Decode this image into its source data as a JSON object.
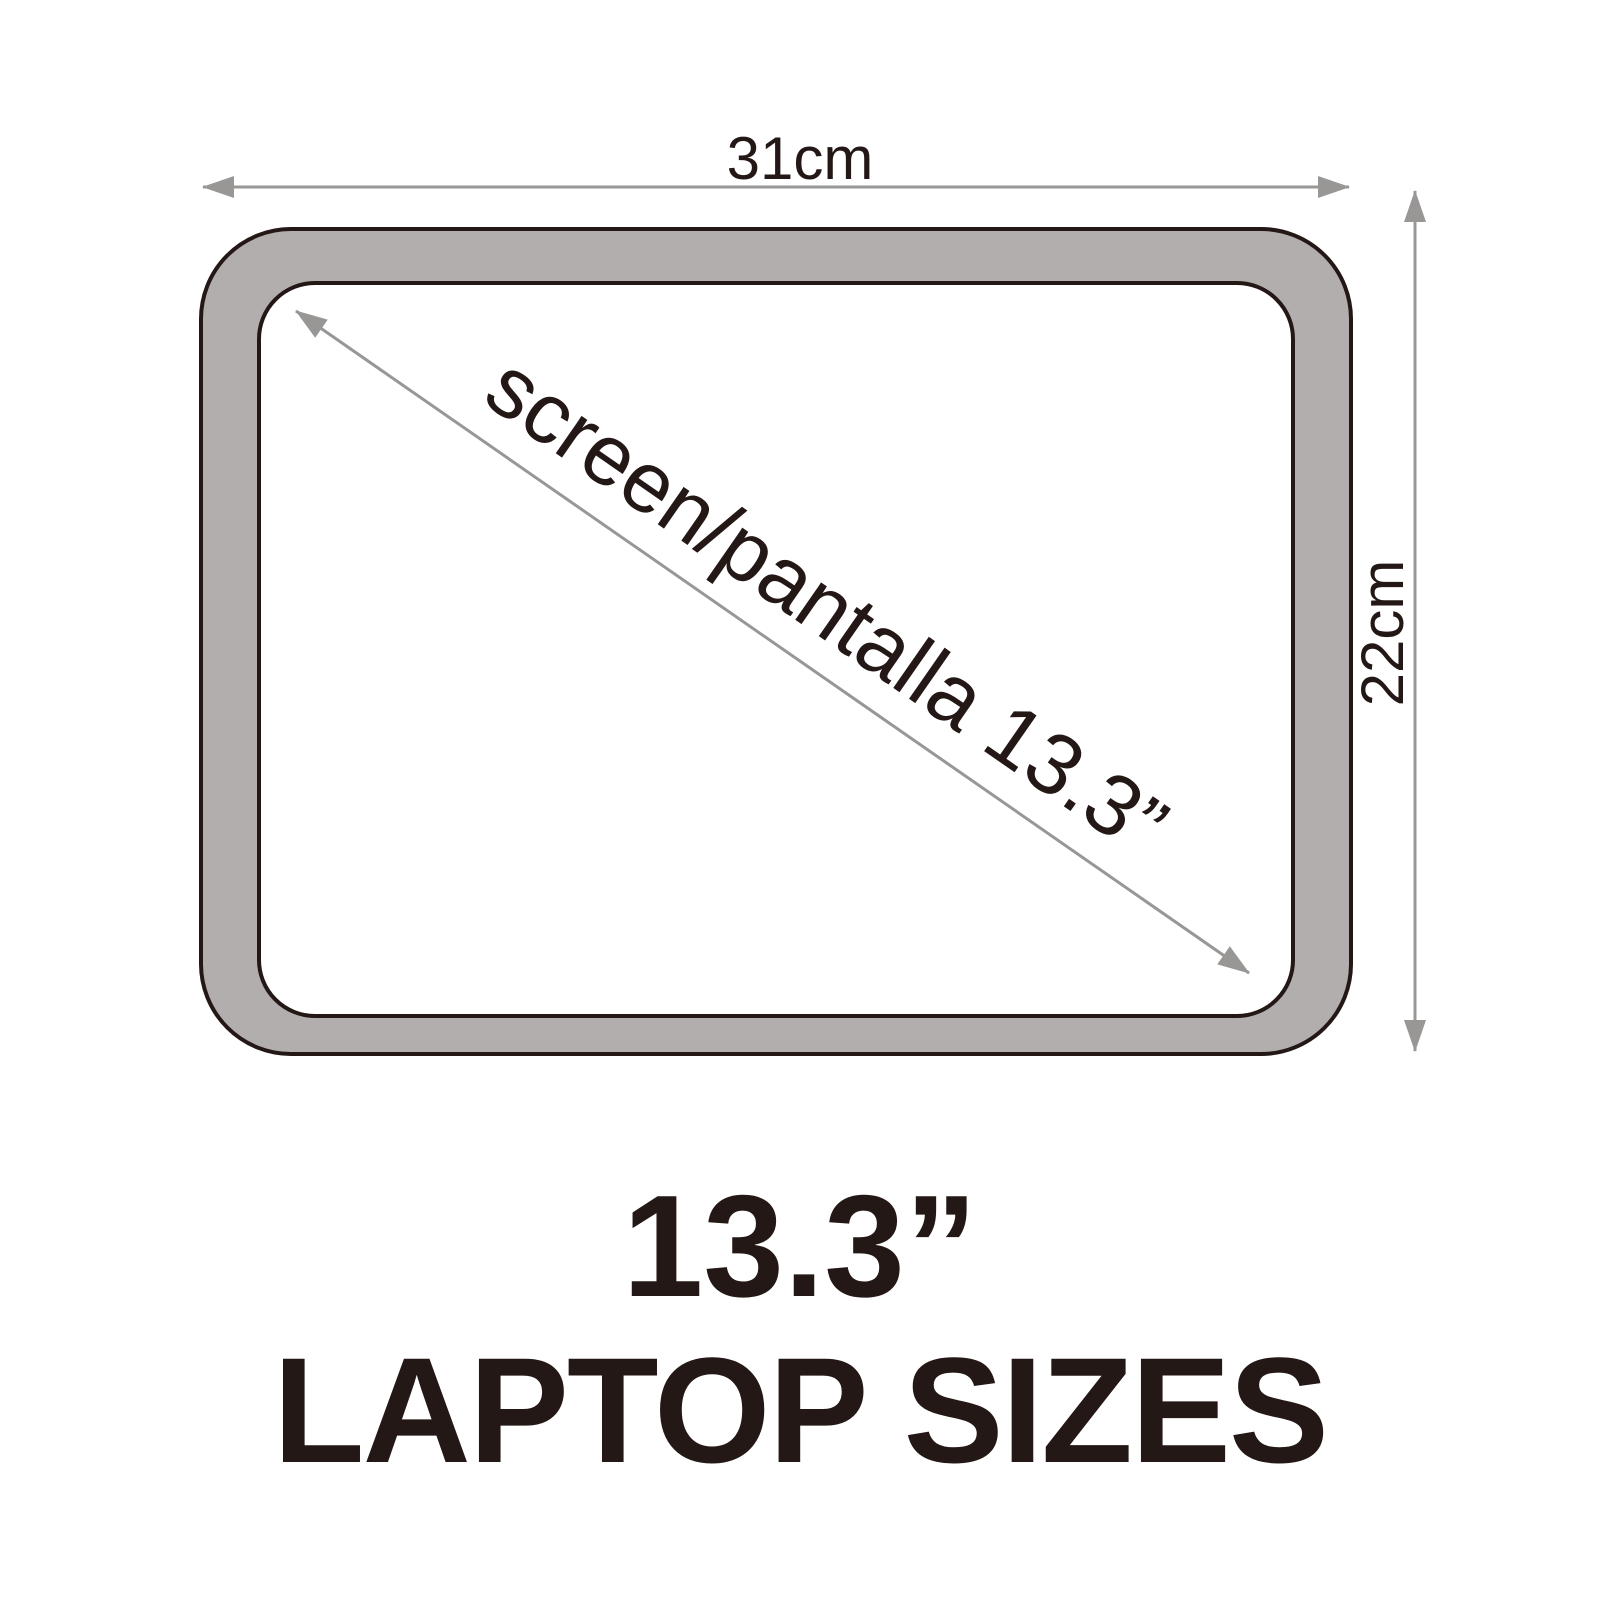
{
  "diagram": {
    "width_label": "31cm",
    "height_label": "22cm",
    "diagonal_label": "screen/pantalla 13.3”",
    "colors": {
      "bezel_gray": "#b3aeae",
      "outline_dark": "#231815",
      "arrow_gray": "#999696",
      "text_dark": "#231815",
      "background": "#ffffff"
    }
  },
  "caption": {
    "size_label": "13.3”",
    "title": "LAPTOP SIZES"
  }
}
